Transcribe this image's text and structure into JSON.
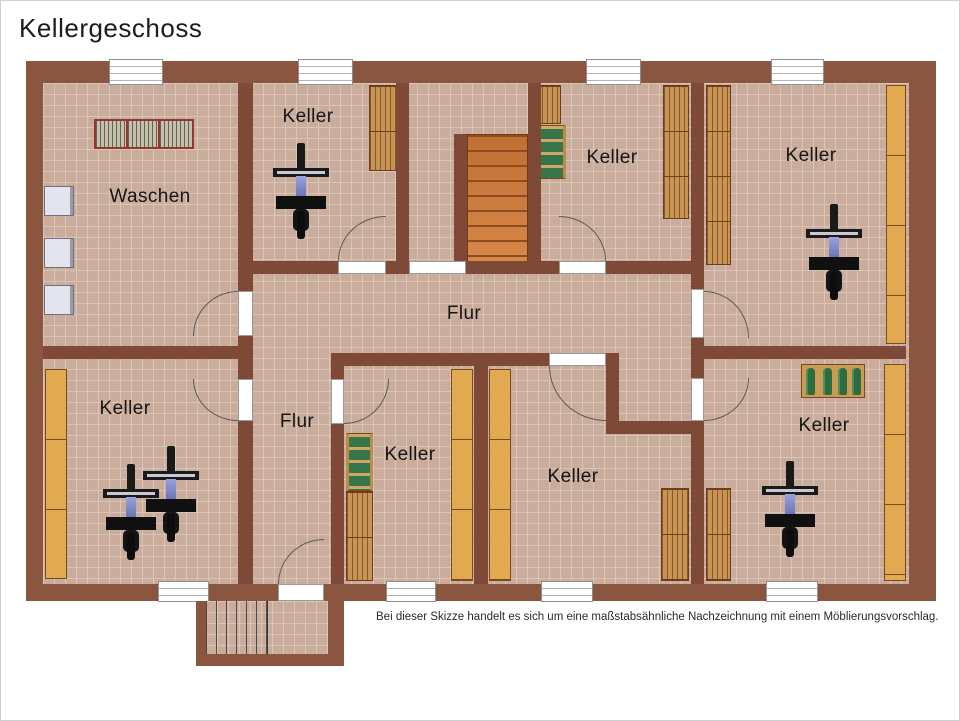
{
  "title": "Kellergeschoss",
  "disclaimer": "Bei dieser Skizze handelt es sich um eine maßstabsähnliche Nachzeichnung mit einem Möblierungsvorschlag.",
  "rooms": {
    "waschen": {
      "label": "Waschen"
    },
    "keller_top_middle": {
      "label": "Keller"
    },
    "keller_top_center": {
      "label": "Keller"
    },
    "keller_top_right": {
      "label": "Keller"
    },
    "flur_main": {
      "label": "Flur"
    },
    "flur_lower": {
      "label": "Flur"
    },
    "keller_bottom_left": {
      "label": "Keller"
    },
    "keller_bottom_small": {
      "label": "Keller"
    },
    "keller_bottom_center": {
      "label": "Keller"
    },
    "keller_bottom_right": {
      "label": "Keller"
    }
  },
  "colors": {
    "wall": "#7e4a37",
    "perimeter": "#8b563f",
    "floor": "#c9ac9c",
    "floor_grid": "#d9c4b6",
    "stairs_orange": "#cf7c3c",
    "shelf_wood": "#c89455",
    "shelf_plain": "#e2aa50",
    "bottle_green": "#2e6b3e",
    "bike_frame_blue": "#4a58a8",
    "appliance_gray": "#e4e4ef",
    "drying_rack_red": "#93372f"
  }
}
